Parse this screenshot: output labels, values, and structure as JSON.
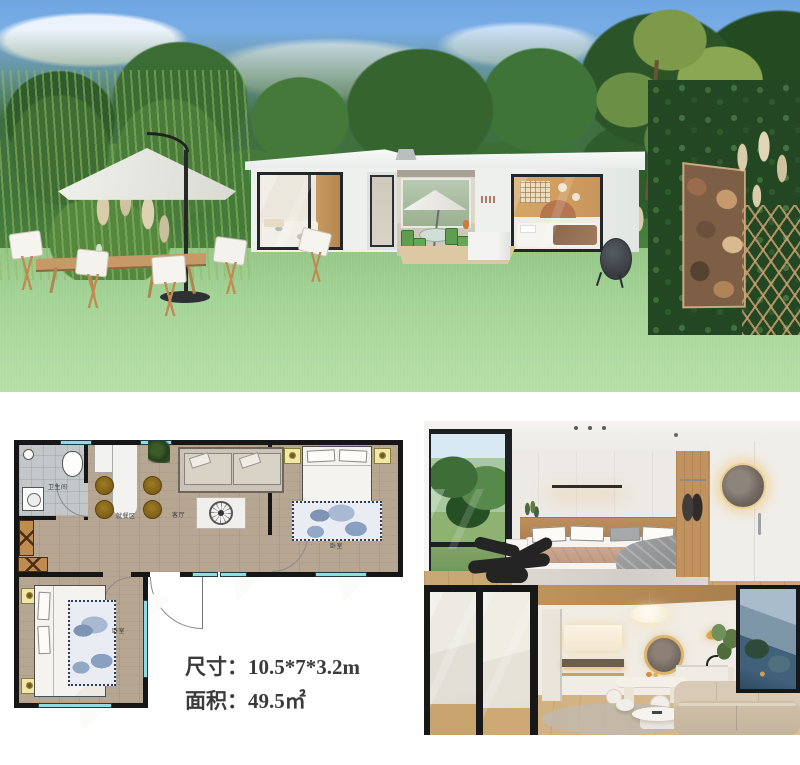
{
  "floor_plan": {
    "rooms": {
      "bathroom": "卫生间",
      "dining": "就餐区",
      "living": "客厅",
      "bedroom_right": "卧室",
      "bedroom_left": "卧室"
    },
    "specs": [
      {
        "label": "尺寸：",
        "value": "10.5*7*3.2m"
      },
      {
        "label": "面积：",
        "value": "49.5㎡"
      }
    ],
    "colors": {
      "wall": "#161616",
      "window": "#8fdce4",
      "wood_floor": "#b7a692",
      "bathroom_floor": "#c4c7c9",
      "rug": "#8aa0c2",
      "dining_chair": "#8a671d",
      "nightstand": "#f1e7a8"
    }
  },
  "exterior_photo": {
    "sky": "#7fb0e4",
    "lawn": "#9acb8b",
    "foliage": "#35642f",
    "house": "#eef0ee",
    "frame": "#23272a"
  },
  "interior_photos": {
    "wood_accent": "#c49763",
    "wall": "#edeae5",
    "sofa": "#cfc0a8"
  }
}
